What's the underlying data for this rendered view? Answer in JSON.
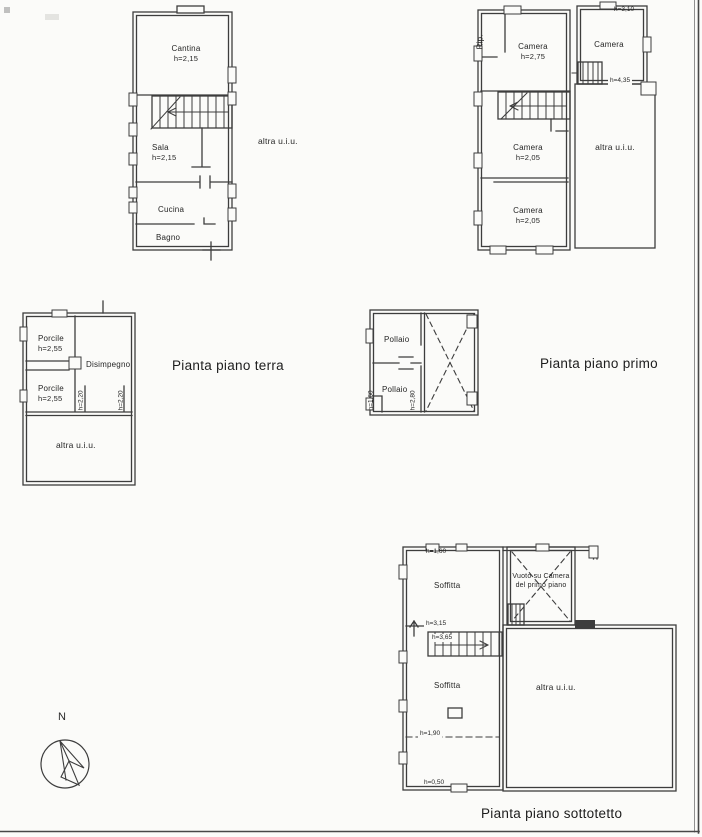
{
  "colors": {
    "paper": "#fbfbf9",
    "ink": "#3d3d3d",
    "text": "#262626"
  },
  "captions": {
    "ground": "Pianta piano terra",
    "first": "Pianta piano primo",
    "attic": "Pianta piano sottotetto"
  },
  "compass": {
    "north": "N"
  },
  "top_left_plan": {
    "cantina": {
      "name": "Cantina",
      "h": "h=2,15"
    },
    "sala": {
      "name": "Sala",
      "h": "h=2,15"
    },
    "cucina": {
      "name": "Cucina"
    },
    "bagno": {
      "name": "Bagno"
    },
    "altra": "altra u.i.u."
  },
  "top_right_plan": {
    "rip": "Rip.",
    "camera_275": {
      "name": "Camera",
      "h": "h=2,75"
    },
    "camera_310": {
      "name": "Camera",
      "h_top": "h=3,10",
      "h_bottom": "h=4,35"
    },
    "camera_205_a": {
      "name": "Camera",
      "h": "h=2,05"
    },
    "camera_205_b": {
      "name": "Camera",
      "h": "h=2,05"
    },
    "altra": "altra u.i.u."
  },
  "mid_left_plan": {
    "porcile_a": {
      "name": "Porcile",
      "h": "h=2,55"
    },
    "disimpegno": "Disimpegno",
    "porcile_b": {
      "name": "Porcile",
      "h": "h=2,55"
    },
    "h_left": "h=2,20",
    "h_right": "h=2,20",
    "altra": "altra u.i.u."
  },
  "mid_right_plan": {
    "pollaio_a": "Pollaio",
    "pollaio_b": "Pollaio",
    "h_left": "h=1,60",
    "h_right": "h=2,80"
  },
  "bottom_plan": {
    "h_top": "h=1,60",
    "soffitta_a": "Soffitta",
    "vuoto_line1": "Vuoto su Camera",
    "vuoto_line2": "del primo piano",
    "h_315": "h=3,15",
    "h_365": "h=3,65",
    "soffitta_b": "Soffitta",
    "altra": "altra u.i.u.",
    "h_190": "h=1,90",
    "h_050": "h=0,50"
  }
}
